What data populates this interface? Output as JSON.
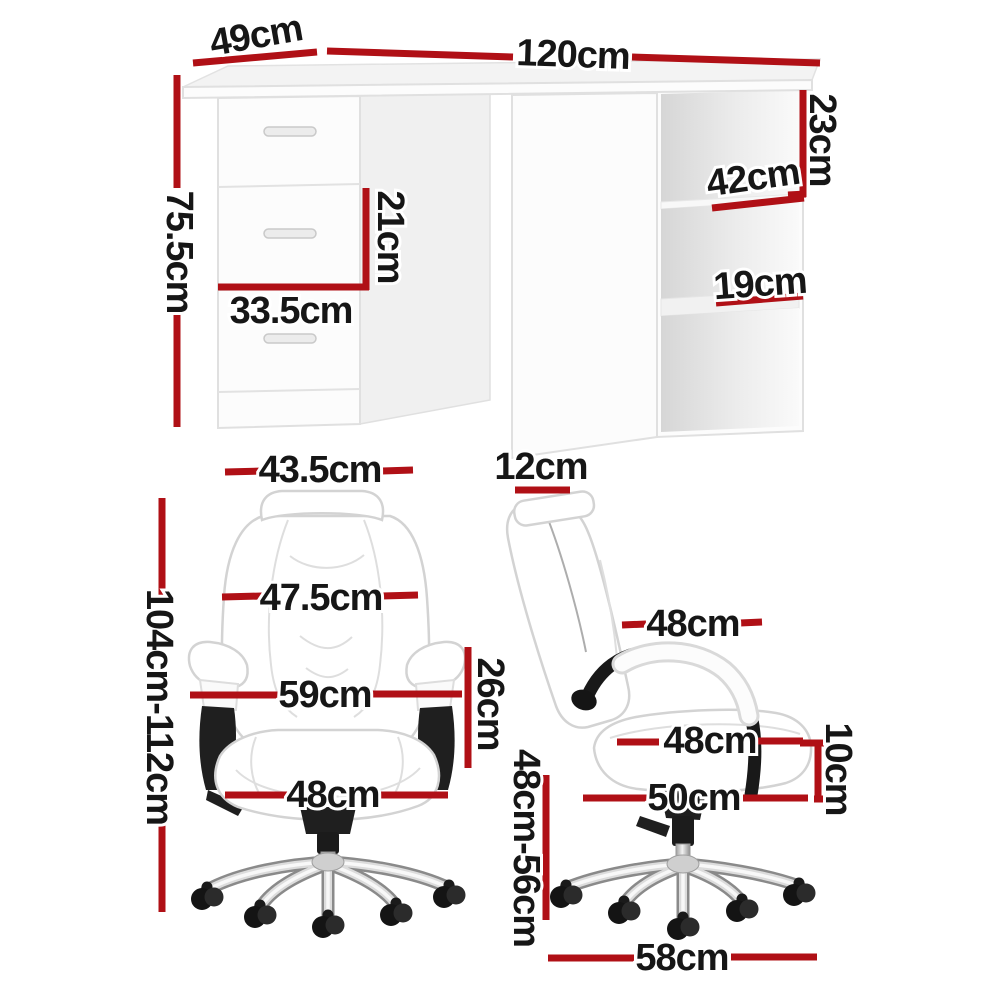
{
  "title": "Desk and office chair dimension diagram",
  "colors": {
    "dimension_red": "#b01016",
    "label_ink": "#161616"
  },
  "desk": {
    "depth": "49cm",
    "width": "120cm",
    "height": "75.5cm",
    "drawer_height": "21cm",
    "drawer_width": "33.5cm",
    "shelf_top_height": "23cm",
    "shelf_depth": "42cm",
    "shelf_middle_height": "19cm"
  },
  "chair_front": {
    "headrest_width": "43.5cm",
    "overall_height_range": "104cm-112cm",
    "backrest_width": "47.5cm",
    "armrest_span": "59cm",
    "armrest_height": "26cm",
    "seat_width": "48cm"
  },
  "chair_side": {
    "backrest_thickness": "12cm",
    "backrest_width": "48cm",
    "seat_depth": "48cm",
    "seat_thickness": "10cm",
    "seat_length": "50cm",
    "seat_height_range": "48cm-56cm",
    "base_width": "58cm"
  }
}
